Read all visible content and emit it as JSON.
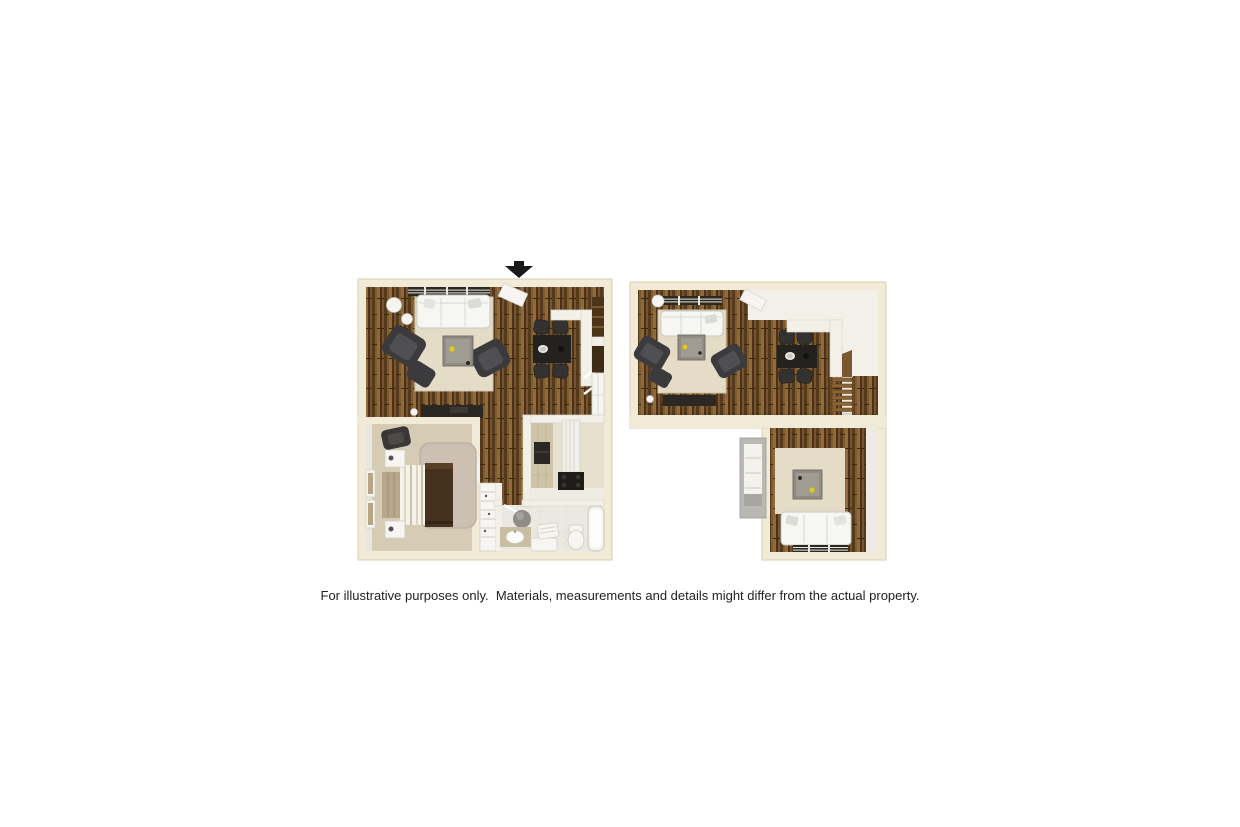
{
  "page": {
    "width": 1240,
    "height": 827,
    "background": "#ffffff",
    "disclaimer": "For illustrative purposes only.  Materials, measurements and details might differ from the actual property."
  },
  "entrance_arrow": {
    "icon": "down-arrow",
    "color": "#1a1a1a"
  },
  "floorplans": [
    {
      "name": "left-unit",
      "type": "3d-rendered-floor-plan",
      "rooms": [
        "living-room",
        "dining-area",
        "kitchen",
        "hallway",
        "bedroom",
        "bathroom",
        "closet"
      ],
      "furniture": [
        "sofa",
        "two-armchairs",
        "ottoman",
        "coffee-table",
        "round-side-tables",
        "tv-stand",
        "dining-table-with-4-chairs",
        "window-blinds",
        "entry-door",
        "bed",
        "two-nightstands",
        "bedroom-chair",
        "wall-art",
        "kitchen-counter",
        "refrigerator",
        "stove",
        "closet-shelves",
        "vanity-sink",
        "toilet",
        "bathtub"
      ]
    },
    {
      "name": "right-unit",
      "type": "3d-rendered-floor-plan",
      "rooms": [
        "living-room",
        "dining-area",
        "entry",
        "stair-corridor",
        "den",
        "closet"
      ],
      "furniture": [
        "sofa",
        "two-armchairs",
        "ottoman",
        "coffee-table",
        "round-side-table",
        "tv-stand",
        "dining-table-with-4-chairs",
        "window-blinds",
        "entry-door",
        "staircase",
        "den-coffee-table",
        "den-sofa",
        "closet-shelves"
      ]
    }
  ],
  "colors": {
    "background": "#ffffff",
    "wall_cream": "#f0ead6",
    "wall_edge": "#d7cfb5",
    "wall_white": "#f2f0e9",
    "wood_floor": "#6e4c27",
    "rug_beige": "#e4dcc6",
    "carpet_beige": "#d6ccb6",
    "shag_rug": "#cbc0b2",
    "sofa_white": "#f6f6f3",
    "furniture_dark": "#3b3b3d",
    "table_gray": "#908c84",
    "dining_dark": "#24221f",
    "bed_brown": "#46311f",
    "stair_wood": "#8a6437",
    "accent_yellow": "#d8c93a",
    "arrow_black": "#1a1a1a",
    "text_color": "#222222"
  }
}
